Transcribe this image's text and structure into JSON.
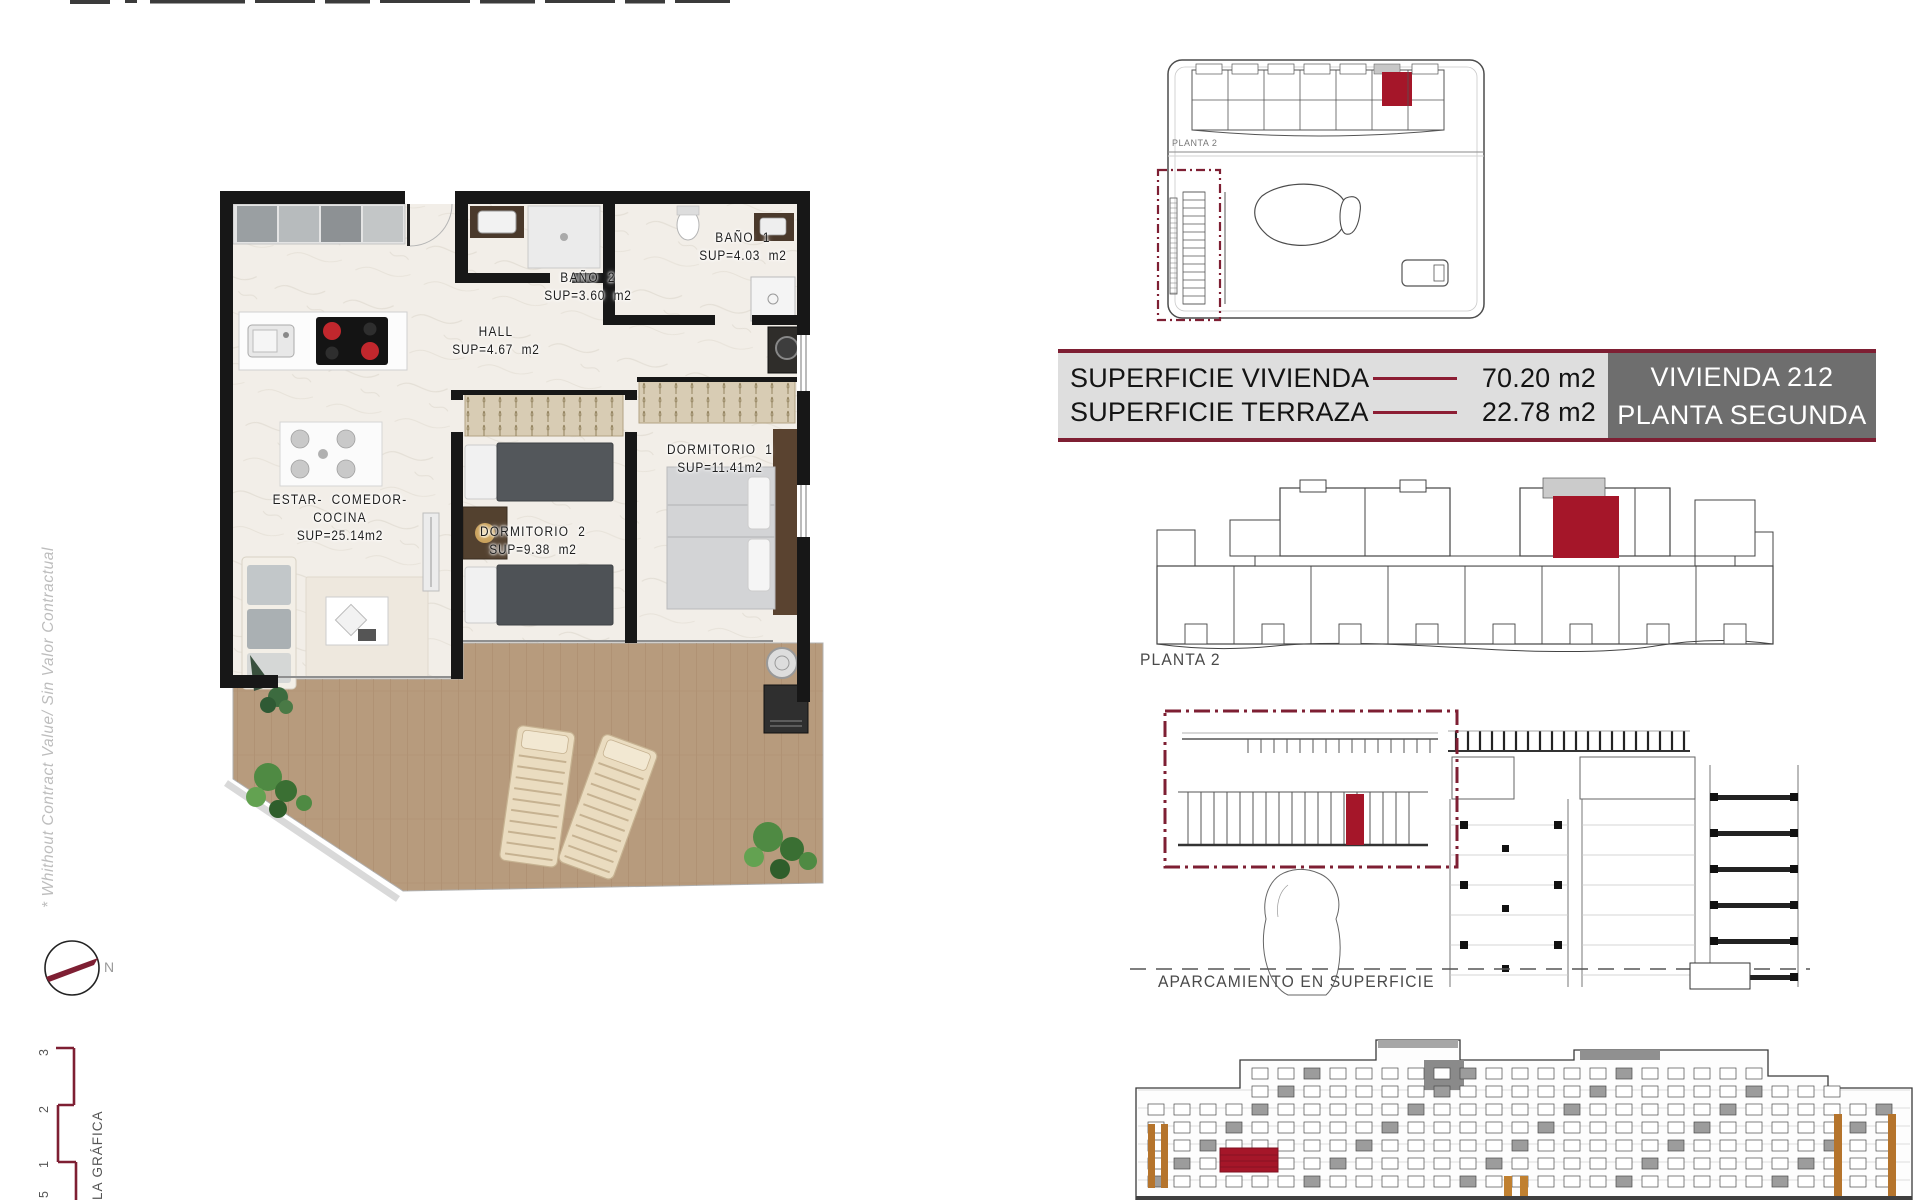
{
  "floor_plan": {
    "rooms": [
      {
        "name": "ESTAR- COMEDOR-COCINA",
        "sup": "SUP=25.14m2"
      },
      {
        "name": "HALL",
        "sup": "SUP=4.67 m2"
      },
      {
        "name": "BAÑO 2",
        "sup": "SUP=3.60 m2"
      },
      {
        "name": "BAÑO 1",
        "sup": "SUP=4.03 m2"
      },
      {
        "name": "DORMITORIO 2",
        "sup": "SUP=9.38 m2"
      },
      {
        "name": "DORMITORIO 1",
        "sup": "SUP=11.41m2"
      }
    ]
  },
  "title_block": {
    "rows": [
      {
        "label": "SUPERFICIE VIVIENDA",
        "value": "70.20 m2"
      },
      {
        "label": "SUPERFICIE TERRAZA",
        "value": "22.78 m2"
      }
    ],
    "unit": "VIVIENDA 212",
    "floor": "PLANTA SEGUNDA"
  },
  "site_plan": {
    "label": "PLANTA 2"
  },
  "building_plan": {
    "label": "PLANTA 2"
  },
  "parking_plan": {
    "label": "APARCAMIENTO EN SUPERFICIE"
  },
  "margin": {
    "disclaimer": "* Whithout Contract Value/ Sin Valor Contractual",
    "compass_north": "N",
    "scale_ticks": [
      "3",
      "2",
      "1",
      "5"
    ],
    "scale_label": "LA GRÁFICA"
  },
  "colors": {
    "maroon": "#7e1f33",
    "crimson": "#a51629"
  }
}
